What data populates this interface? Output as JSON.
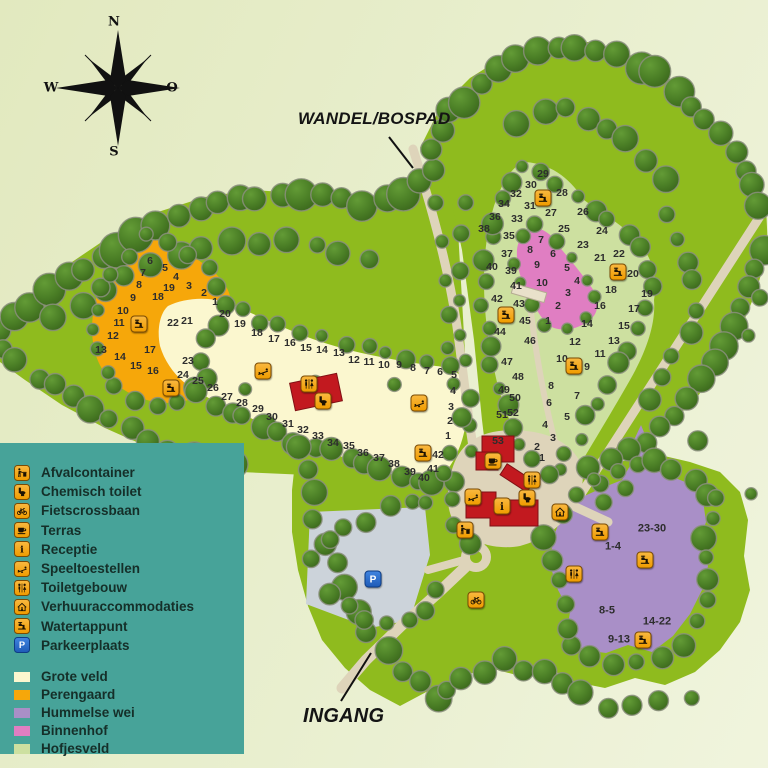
{
  "labels": {
    "path": "WANDEL/BOSPAD",
    "entrance": "INGANG"
  },
  "compass": {
    "north": "N",
    "west": "W",
    "east": "O",
    "south": "S"
  },
  "legend": {
    "items": [
      {
        "icon": "afvalcontainer",
        "label": "Afvalcontainer"
      },
      {
        "icon": "chemisch-toilet",
        "label": "Chemisch toilet"
      },
      {
        "icon": "fietscrossbaan",
        "label": "Fietscrossbaan"
      },
      {
        "icon": "terras",
        "label": "Terras"
      },
      {
        "icon": "receptie",
        "label": "Receptie"
      },
      {
        "icon": "speeltoestellen",
        "label": "Speeltoestellen"
      },
      {
        "icon": "toiletgebouw",
        "label": "Toiletgebouw"
      },
      {
        "icon": "verhuuraccommodaties",
        "label": "Verhuuraccommodaties"
      },
      {
        "icon": "watertappunt",
        "label": "Watertappunt"
      },
      {
        "icon": "parkeerplaats",
        "label": "Parkeerplaats"
      }
    ],
    "areas": [
      {
        "color": "#fbf7cf",
        "label": "Grote veld"
      },
      {
        "color": "#f6a70a",
        "label": "Perengaard"
      },
      {
        "color": "#a98fc7",
        "label": "Hummelse wei"
      },
      {
        "color": "#e07ec2",
        "label": "Binnenhof"
      },
      {
        "color": "#cde0a0",
        "label": "Hofjesveld"
      }
    ]
  },
  "map": {
    "pitch_groups": {
      "perengaard": [
        [
          1,
          215,
          302
        ],
        [
          2,
          204,
          293
        ],
        [
          3,
          189,
          286
        ],
        [
          4,
          176,
          277
        ],
        [
          5,
          165,
          268
        ],
        [
          6,
          150,
          261
        ],
        [
          7,
          143,
          273
        ],
        [
          8,
          139,
          285
        ],
        [
          9,
          133,
          298
        ],
        [
          10,
          123,
          311
        ],
        [
          11,
          119,
          323
        ],
        [
          12,
          113,
          336
        ],
        [
          13,
          101,
          350
        ],
        [
          14,
          120,
          357
        ],
        [
          15,
          136,
          366
        ],
        [
          16,
          153,
          371
        ],
        [
          17,
          150,
          350
        ],
        [
          18,
          158,
          297
        ],
        [
          19,
          169,
          288
        ]
      ],
      "grote_veld": [
        [
          1,
          448,
          436
        ],
        [
          2,
          450,
          421
        ],
        [
          3,
          451,
          407
        ],
        [
          4,
          453,
          391
        ],
        [
          5,
          454,
          375
        ],
        [
          6,
          440,
          372
        ],
        [
          7,
          427,
          371
        ],
        [
          8,
          413,
          368
        ],
        [
          9,
          399,
          365
        ],
        [
          10,
          384,
          365
        ],
        [
          11,
          369,
          362
        ],
        [
          12,
          354,
          360
        ],
        [
          13,
          339,
          353
        ],
        [
          14,
          322,
          350
        ],
        [
          15,
          306,
          348
        ],
        [
          16,
          290,
          343
        ],
        [
          17,
          274,
          339
        ],
        [
          18,
          257,
          333
        ],
        [
          19,
          240,
          324
        ],
        [
          20,
          225,
          314
        ],
        [
          21,
          187,
          321
        ],
        [
          22,
          173,
          323
        ],
        [
          23,
          188,
          361
        ],
        [
          24,
          183,
          375
        ],
        [
          25,
          198,
          381
        ],
        [
          26,
          213,
          388
        ],
        [
          27,
          227,
          397
        ],
        [
          28,
          242,
          403
        ],
        [
          29,
          258,
          409
        ],
        [
          30,
          272,
          417
        ],
        [
          31,
          288,
          424
        ],
        [
          32,
          303,
          430
        ],
        [
          33,
          318,
          436
        ],
        [
          34,
          333,
          443
        ],
        [
          35,
          349,
          446
        ],
        [
          36,
          363,
          453
        ],
        [
          37,
          379,
          458
        ],
        [
          38,
          394,
          464
        ],
        [
          39,
          410,
          472
        ],
        [
          40,
          424,
          478
        ],
        [
          41,
          433,
          469
        ],
        [
          42,
          438,
          455
        ]
      ],
      "binnenhof": [
        [
          1,
          548,
          321
        ],
        [
          2,
          558,
          306
        ],
        [
          3,
          568,
          293
        ],
        [
          4,
          577,
          281
        ],
        [
          5,
          567,
          268
        ],
        [
          6,
          553,
          254
        ],
        [
          7,
          541,
          240
        ],
        [
          8,
          530,
          250
        ],
        [
          9,
          537,
          265
        ],
        [
          10,
          542,
          283
        ]
      ],
      "hofjesveld": [
        [
          1,
          542,
          458
        ],
        [
          2,
          537,
          447
        ],
        [
          3,
          553,
          438
        ],
        [
          4,
          545,
          425
        ],
        [
          5,
          567,
          417
        ],
        [
          6,
          549,
          403
        ],
        [
          7,
          577,
          396
        ],
        [
          8,
          551,
          386
        ],
        [
          9,
          587,
          367
        ],
        [
          10,
          562,
          359
        ],
        [
          11,
          600,
          354
        ],
        [
          12,
          575,
          342
        ],
        [
          13,
          614,
          341
        ],
        [
          14,
          587,
          324
        ],
        [
          15,
          624,
          326
        ],
        [
          16,
          600,
          306
        ],
        [
          17,
          634,
          309
        ],
        [
          18,
          611,
          290
        ],
        [
          19,
          647,
          294
        ],
        [
          20,
          633,
          274
        ],
        [
          21,
          600,
          258
        ],
        [
          22,
          619,
          254
        ],
        [
          23,
          583,
          245
        ],
        [
          24,
          602,
          231
        ],
        [
          25,
          564,
          229
        ],
        [
          26,
          583,
          212
        ],
        [
          27,
          551,
          213
        ],
        [
          28,
          562,
          193
        ],
        [
          29,
          543,
          174
        ],
        [
          30,
          531,
          185
        ],
        [
          31,
          530,
          206
        ],
        [
          32,
          516,
          194
        ],
        [
          33,
          517,
          219
        ],
        [
          34,
          504,
          204
        ],
        [
          35,
          509,
          236
        ],
        [
          36,
          495,
          217
        ],
        [
          37,
          507,
          254
        ],
        [
          38,
          484,
          229
        ],
        [
          39,
          511,
          271
        ],
        [
          40,
          492,
          267
        ],
        [
          41,
          516,
          286
        ],
        [
          42,
          497,
          299
        ],
        [
          43,
          519,
          304
        ],
        [
          44,
          500,
          332
        ],
        [
          45,
          525,
          321
        ],
        [
          46,
          530,
          341
        ],
        [
          47,
          507,
          362
        ],
        [
          48,
          518,
          377
        ],
        [
          49,
          504,
          390
        ],
        [
          50,
          515,
          398
        ],
        [
          51,
          502,
          415
        ],
        [
          52,
          513,
          413
        ],
        [
          53,
          498,
          441
        ]
      ]
    },
    "hummelse_wei_ranges": [
      [
        "23-30",
        652,
        529
      ],
      [
        "1-4",
        613,
        547
      ],
      [
        "8-5",
        607,
        611
      ],
      [
        "14-22",
        657,
        622
      ],
      [
        "9-13",
        619,
        640
      ]
    ],
    "icons": [
      [
        "watertappunt",
        139,
        324
      ],
      [
        "watertappunt",
        171,
        388
      ],
      [
        "watertappunt",
        423,
        453
      ],
      [
        "watertappunt",
        543,
        198
      ],
      [
        "watertappunt",
        618,
        272
      ],
      [
        "watertappunt",
        506,
        315
      ],
      [
        "watertappunt",
        574,
        366
      ],
      [
        "watertappunt",
        600,
        532
      ],
      [
        "watertappunt",
        645,
        560
      ],
      [
        "watertappunt",
        643,
        640
      ],
      [
        "speeltoestellen",
        263,
        371
      ],
      [
        "speeltoestellen",
        419,
        403
      ],
      [
        "speeltoestellen",
        473,
        497
      ],
      [
        "toiletgebouw",
        309,
        384
      ],
      [
        "toiletgebouw",
        532,
        480
      ],
      [
        "toiletgebouw",
        574,
        574
      ],
      [
        "chemisch-toilet",
        323,
        401
      ],
      [
        "chemisch-toilet",
        527,
        498
      ],
      [
        "terras",
        493,
        461
      ],
      [
        "receptie",
        502,
        506
      ],
      [
        "verhuuraccommodaties",
        560,
        512
      ],
      [
        "afvalcontainer",
        465,
        530
      ],
      [
        "fietscrossbaan",
        476,
        600
      ],
      [
        "parkeerplaats",
        373,
        579
      ]
    ]
  },
  "colors": {
    "background": "#e6ecc6",
    "forest": "#8fbb1e",
    "grote_veld": "#fbf7cf",
    "perengaard": "#f6a70a",
    "hummelse_wei": "#a98fc7",
    "binnenhof": "#e07ec2",
    "hofjesveld": "#cde0a0",
    "path": "#ded4ba",
    "parking": "#ccd3da",
    "building": "#c2191f",
    "legend_bg": "#47a399",
    "pitch_text": "#2d2d2d"
  }
}
